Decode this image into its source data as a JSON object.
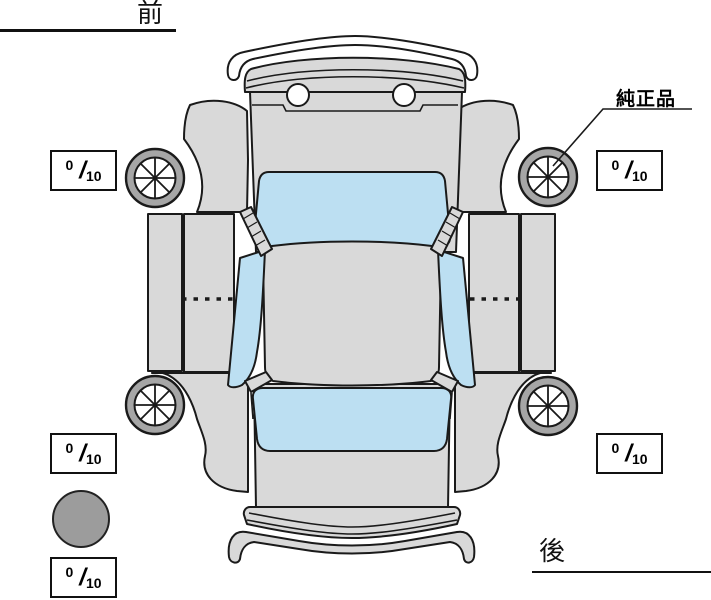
{
  "labels": {
    "front": "前",
    "rear": "後",
    "genuine_part": "純正品"
  },
  "tread": {
    "front_left": {
      "num": "0",
      "slash": "/",
      "den": "10"
    },
    "front_right": {
      "num": "0",
      "slash": "/",
      "den": "10"
    },
    "rear_left": {
      "num": "0",
      "slash": "/",
      "den": "10"
    },
    "rear_right": {
      "num": "0",
      "slash": "/",
      "den": "10"
    },
    "spare": {
      "num": "0",
      "slash": "/",
      "den": "10"
    }
  },
  "colors": {
    "body": "#d9d9d9",
    "glass": "#bcdff2",
    "tire": "#a6a6a6",
    "spare": "#9c9c9c",
    "outline": "#1a1a1a"
  },
  "diagram": {
    "type": "car-top-view-unfolded",
    "glass_panels": [
      "windshield",
      "left-side-window",
      "right-side-window",
      "rear-window"
    ],
    "wheels": [
      "front-left",
      "front-right",
      "rear-left",
      "rear-right"
    ],
    "spare_tire_shown": true
  }
}
